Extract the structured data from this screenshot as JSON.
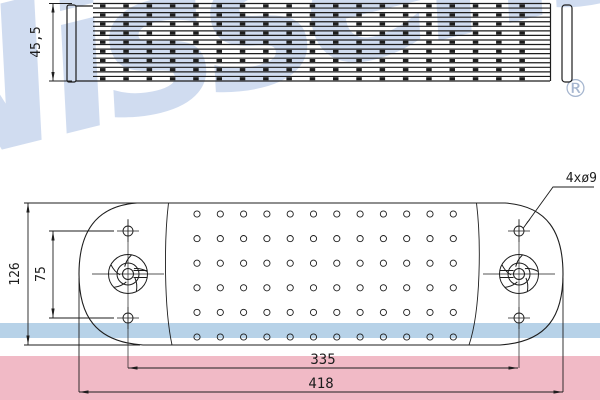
{
  "brand": {
    "watermark_text": "Nissens",
    "registered_mark": "®"
  },
  "annotations": {
    "side_height": "45,5",
    "front_height": "126",
    "bolt_spacing_vertical": "75",
    "bolt_spacing_horizontal": "335",
    "overall_width": "418",
    "bolt_holes_label": "4xø9"
  },
  "colors": {
    "line": "#1d1d1d",
    "watermark": "#a3bbe2",
    "band_blue": "#b7d2e8",
    "band_pink": "#f1bac6",
    "registered_mark": "#a6b6cf"
  },
  "drawing": {
    "side_view": {
      "core_x1": 93,
      "core_x2": 550,
      "core_y1": 3.5,
      "core_y2": 81,
      "tube_lines": 18,
      "fin_rows": 9,
      "fin_start_x": 100,
      "fin_end_x": 540,
      "fin_pitch": 23.3,
      "fin_w": 5.5,
      "fin_h": 3
    },
    "front_view": {
      "hole_grid": {
        "cols": 12,
        "rows": 6,
        "x0": 197,
        "y0": 214,
        "dx": 23.3,
        "dy": 24.6,
        "r": 3.1
      },
      "bolt_holes": [
        [
          128,
          231
        ],
        [
          128,
          318
        ],
        [
          519,
          231
        ],
        [
          519,
          318
        ]
      ],
      "bolt_hole_r": 5,
      "bosses": [
        {
          "cx": 128,
          "cy": 274,
          "dir": 1
        },
        {
          "cx": 519,
          "cy": 274,
          "dir": -1
        }
      ],
      "boss_radii": [
        19.5,
        11,
        5.5
      ],
      "centerline_x": [
        128,
        519
      ],
      "centerline_y1": 219,
      "centerline_y2": 368
    }
  }
}
